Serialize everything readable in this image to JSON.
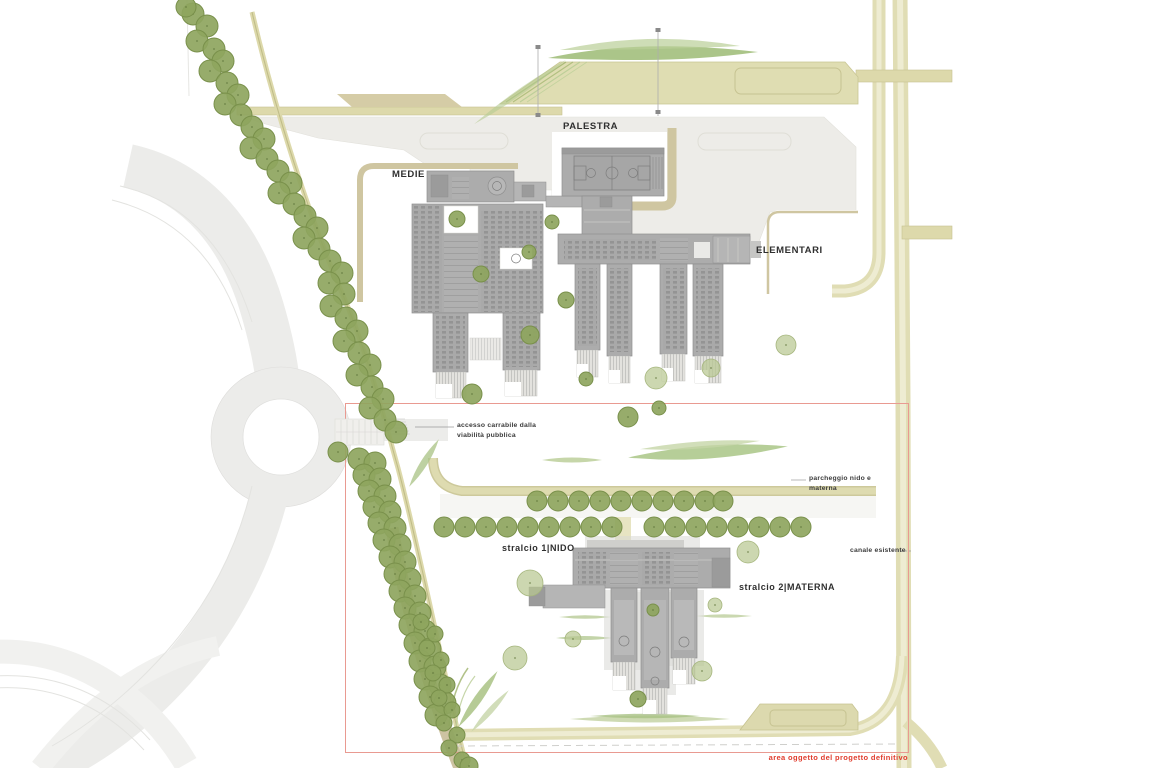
{
  "title": "school campus site plan",
  "labels": {
    "palestra": "PALESTRA",
    "medie": "MEDIE",
    "elementari": "ELEMENTARI",
    "accesso_line1": "accesso carrabile dalla",
    "accesso_line2": "viabilità pubblica",
    "parcheggio_line1": "parcheggio nido e",
    "parcheggio_line2": "materna",
    "canale": "canale esistente",
    "stralcio1": "stralcio 1|NIDO",
    "stralcio2": "stralcio 2|MATERNA",
    "area_boundary": "area oggetto del progetto definitivo"
  },
  "colors": {
    "tree": "#8ea55e",
    "treeEdge": "#79904b",
    "treePale": "#b9c792",
    "treePaleEdge": "#a6b67e",
    "khaki": "#ddd9ab",
    "khakiEdge": "#c6c292",
    "road": "#ececea",
    "plaza": "#edece8",
    "bld": "#acacac",
    "bldEdge": "#8f8f8f",
    "tan": "#cdc3a2",
    "red": "#e03c2d",
    "redLine": "#e99a91",
    "oliveA": "#a9c284",
    "oliveB": "#c9d6ab"
  },
  "trees": {
    "dark": [
      [
        193,
        14,
        11
      ],
      [
        207,
        26,
        11
      ],
      [
        197,
        41,
        11
      ],
      [
        214,
        49,
        11
      ],
      [
        223,
        61,
        11
      ],
      [
        210,
        71,
        11
      ],
      [
        227,
        83,
        11
      ],
      [
        238,
        95,
        11
      ],
      [
        225,
        104,
        11
      ],
      [
        241,
        115,
        11
      ],
      [
        252,
        127,
        11
      ],
      [
        264,
        139,
        11
      ],
      [
        251,
        148,
        11
      ],
      [
        267,
        159,
        11
      ],
      [
        278,
        171,
        11
      ],
      [
        291,
        183,
        11
      ],
      [
        279,
        193,
        11
      ],
      [
        294,
        204,
        11
      ],
      [
        305,
        216,
        11
      ],
      [
        317,
        228,
        11
      ],
      [
        304,
        238,
        11
      ],
      [
        319,
        249,
        11
      ],
      [
        330,
        261,
        11
      ],
      [
        342,
        273,
        11
      ],
      [
        329,
        283,
        11
      ],
      [
        344,
        294,
        11
      ],
      [
        331,
        306,
        11
      ],
      [
        346,
        318,
        11
      ],
      [
        357,
        331,
        11
      ],
      [
        344,
        341,
        11
      ],
      [
        359,
        353,
        11
      ],
      [
        370,
        365,
        11
      ],
      [
        357,
        375,
        11
      ],
      [
        372,
        387,
        11
      ],
      [
        383,
        399,
        11
      ],
      [
        370,
        408,
        11
      ],
      [
        385,
        420,
        11
      ],
      [
        396,
        432,
        11
      ],
      [
        338,
        452,
        10
      ],
      [
        359,
        459,
        11
      ],
      [
        375,
        463,
        11
      ],
      [
        364,
        475,
        11
      ],
      [
        380,
        479,
        11
      ],
      [
        369,
        491,
        11
      ],
      [
        385,
        496,
        11
      ],
      [
        374,
        507,
        11
      ],
      [
        390,
        512,
        11
      ],
      [
        379,
        523,
        11
      ],
      [
        395,
        528,
        11
      ],
      [
        384,
        540,
        11
      ],
      [
        400,
        545,
        11
      ],
      [
        390,
        557,
        11
      ],
      [
        405,
        562,
        11
      ],
      [
        395,
        574,
        11
      ],
      [
        410,
        579,
        11
      ],
      [
        400,
        591,
        11
      ],
      [
        415,
        596,
        11
      ],
      [
        405,
        608,
        11
      ],
      [
        420,
        613,
        11
      ],
      [
        410,
        625,
        11
      ],
      [
        425,
        631,
        11
      ],
      [
        415,
        643,
        11
      ],
      [
        430,
        649,
        11
      ],
      [
        420,
        661,
        11
      ],
      [
        435,
        667,
        11
      ],
      [
        425,
        679,
        11
      ],
      [
        440,
        685,
        11
      ],
      [
        430,
        697,
        11
      ],
      [
        445,
        703,
        11
      ],
      [
        436,
        715,
        11
      ],
      [
        537,
        501,
        10
      ],
      [
        558,
        501,
        10
      ],
      [
        579,
        501,
        10
      ],
      [
        600,
        501,
        10
      ],
      [
        621,
        501,
        10
      ],
      [
        642,
        501,
        10
      ],
      [
        663,
        501,
        10
      ],
      [
        684,
        501,
        10
      ],
      [
        705,
        501,
        10
      ],
      [
        723,
        501,
        10
      ],
      [
        444,
        527,
        10
      ],
      [
        465,
        527,
        10
      ],
      [
        486,
        527,
        10
      ],
      [
        507,
        527,
        10
      ],
      [
        528,
        527,
        10
      ],
      [
        549,
        527,
        10
      ],
      [
        570,
        527,
        10
      ],
      [
        591,
        527,
        10
      ],
      [
        612,
        527,
        10
      ],
      [
        654,
        527,
        10
      ],
      [
        675,
        527,
        10
      ],
      [
        696,
        527,
        10
      ],
      [
        717,
        527,
        10
      ],
      [
        738,
        527,
        10
      ],
      [
        759,
        527,
        10
      ],
      [
        780,
        527,
        10
      ],
      [
        801,
        527,
        10
      ],
      [
        421,
        622,
        8
      ],
      [
        435,
        634,
        8
      ],
      [
        427,
        648,
        8
      ],
      [
        441,
        660,
        8
      ],
      [
        433,
        673,
        8
      ],
      [
        447,
        685,
        8
      ],
      [
        439,
        698,
        8
      ],
      [
        452,
        710,
        8
      ],
      [
        444,
        723,
        8
      ],
      [
        457,
        735,
        8
      ],
      [
        449,
        748,
        8
      ],
      [
        462,
        760,
        8
      ],
      [
        457,
        219,
        8
      ],
      [
        552,
        222,
        7
      ],
      [
        481,
        274,
        8
      ],
      [
        529,
        252,
        7
      ],
      [
        566,
        300,
        8
      ],
      [
        530,
        335,
        9
      ],
      [
        472,
        394,
        10
      ],
      [
        586,
        379,
        7
      ],
      [
        628,
        417,
        10
      ],
      [
        659,
        408,
        7
      ],
      [
        186,
        7,
        10
      ],
      [
        469,
        766,
        9
      ],
      [
        653,
        610,
        6
      ],
      [
        638,
        699,
        8
      ]
    ],
    "pale": [
      [
        656,
        378,
        11
      ],
      [
        711,
        368,
        9
      ],
      [
        786,
        345,
        10
      ],
      [
        530,
        583,
        13
      ],
      [
        748,
        552,
        11
      ],
      [
        515,
        658,
        12
      ],
      [
        573,
        639,
        8
      ],
      [
        702,
        671,
        10
      ],
      [
        715,
        605,
        7
      ]
    ]
  }
}
